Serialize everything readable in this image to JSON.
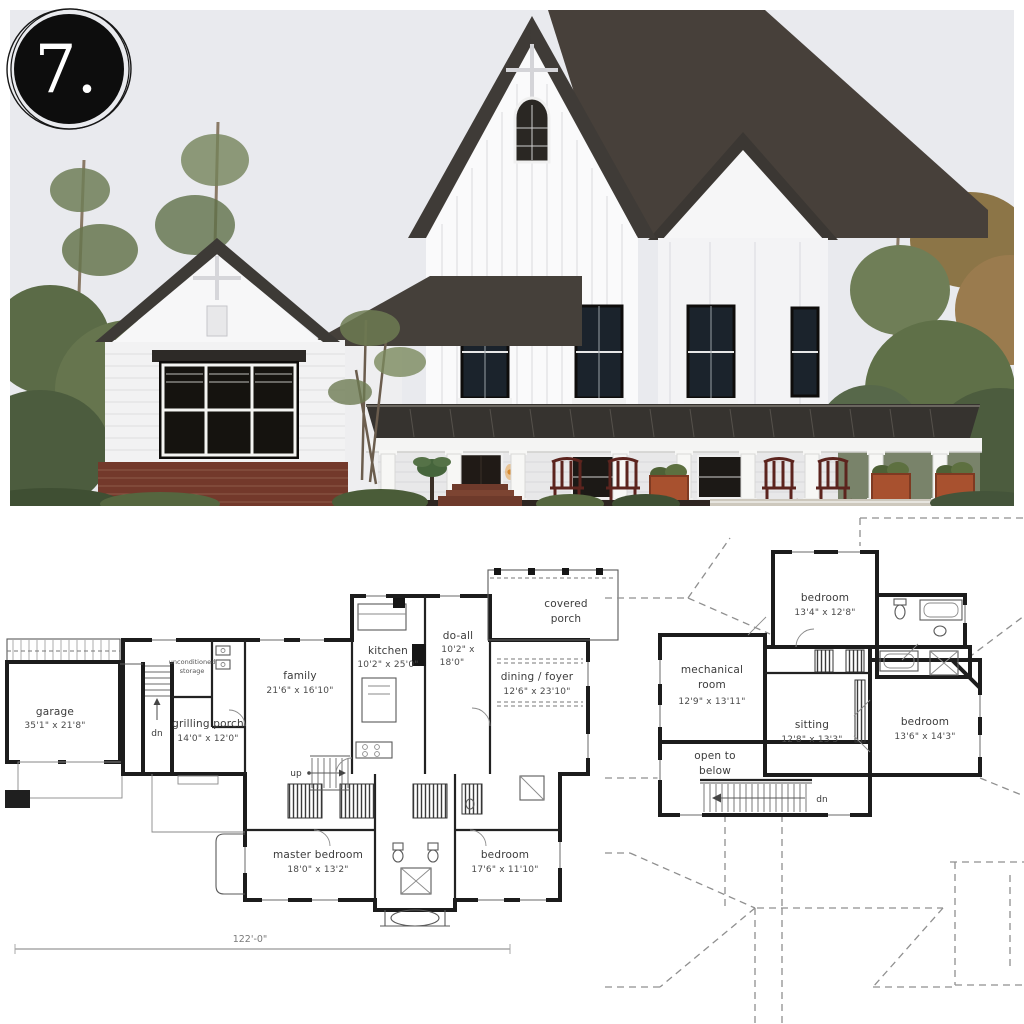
{
  "badge": {
    "number": "7."
  },
  "photo": {
    "alt": "Two-story white modern farmhouse, dark gable roofs, black framed windows, wraparound porch with white columns, rocking chairs, planters and brick foundation among trees",
    "colors": {
      "sky": "#e9eaee",
      "roof": "#3f3b37",
      "siding": "#fafafa",
      "window": "#1d1b19",
      "brick": "#73392b",
      "porch_metal": "#36332f",
      "foliage": "#5f7048",
      "chair": "#5c241e",
      "planter": "#a8512f"
    }
  },
  "first_floor_plan": {
    "rooms": [
      {
        "label_lines": [
          "garage",
          "35'1\" x 21'8\""
        ]
      },
      {
        "label_lines": [
          "unconditioned",
          "storage"
        ]
      },
      {
        "label_lines": [
          "grilling porch",
          "14'0\" x 12'0\""
        ]
      },
      {
        "label_lines": [
          "family",
          "21'6\" x 16'10\""
        ]
      },
      {
        "label_lines": [
          "kitchen",
          "10'2\" x 25'0\""
        ]
      },
      {
        "label_lines": [
          "do-all",
          "10'2\" x",
          "18'0\""
        ]
      },
      {
        "label_lines": [
          "dining / foyer",
          "12'6\" x 23'10\""
        ]
      },
      {
        "label_lines": [
          "covered",
          "porch"
        ]
      },
      {
        "label_lines": [
          "master bedroom",
          "18'0\" x 13'2\""
        ]
      },
      {
        "label_lines": [
          "bedroom",
          "17'6\" x 11'10\""
        ]
      }
    ],
    "annotations": {
      "up": "up",
      "dn": "dn",
      "overall_width": "122'-0\""
    }
  },
  "second_floor_plan": {
    "rooms": [
      {
        "label_lines": [
          "bedroom",
          "13'4\" x 12'8\""
        ]
      },
      {
        "label_lines": [
          "mechanical",
          "room",
          "12'9\" x 13'11\""
        ]
      },
      {
        "label_lines": [
          "sitting",
          "12'8\" x 13'3\""
        ]
      },
      {
        "label_lines": [
          "bedroom",
          "13'6\" x 14'3\""
        ]
      },
      {
        "label_lines": [
          "open to",
          "below"
        ]
      }
    ],
    "annotations": {
      "dn": "dn"
    }
  }
}
